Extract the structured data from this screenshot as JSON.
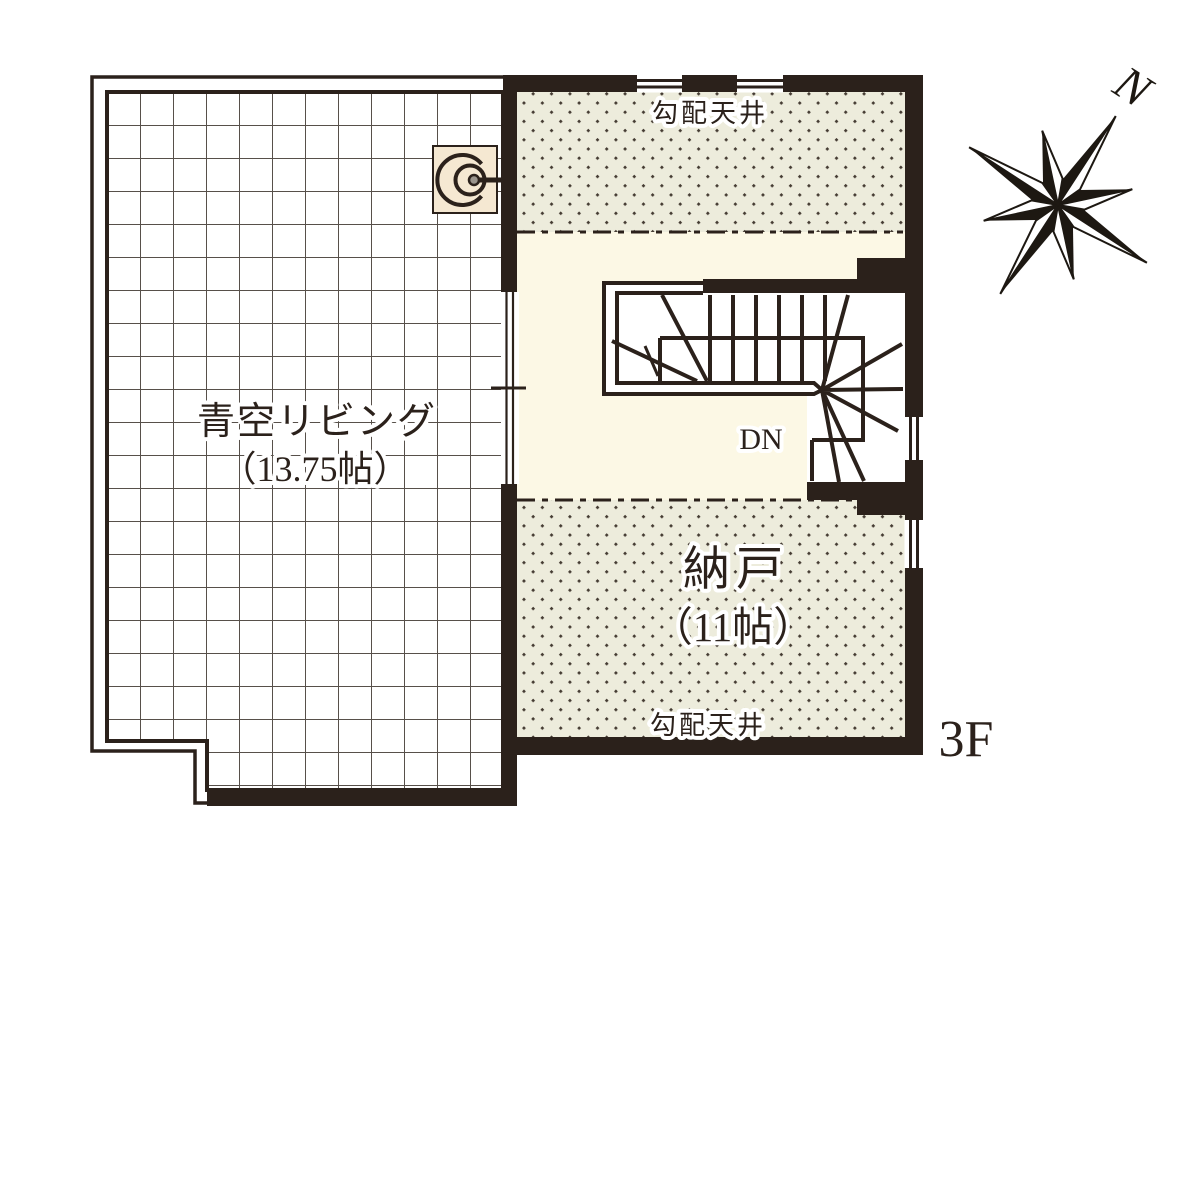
{
  "plan": {
    "floor_label": "3F",
    "compass_north_label": "N",
    "balcony": {
      "name": "青空リビング",
      "size": "（13.75帖）"
    },
    "storage": {
      "name": "納戸",
      "size": "（11帖）"
    },
    "sloped_ceiling_label_top": "勾配天井",
    "sloped_ceiling_label_bottom": "勾配天井",
    "stair_direction_label": "DN"
  },
  "colors": {
    "wall": "#2b211b",
    "room_bg": "#fcf8e5",
    "hatch_bg": "#edecdc",
    "hatch_dot": "#453c33",
    "grid_bg": "#ffffff",
    "fixture_bg": "#f5e8d2",
    "fixture_dot": "#9a948c"
  }
}
